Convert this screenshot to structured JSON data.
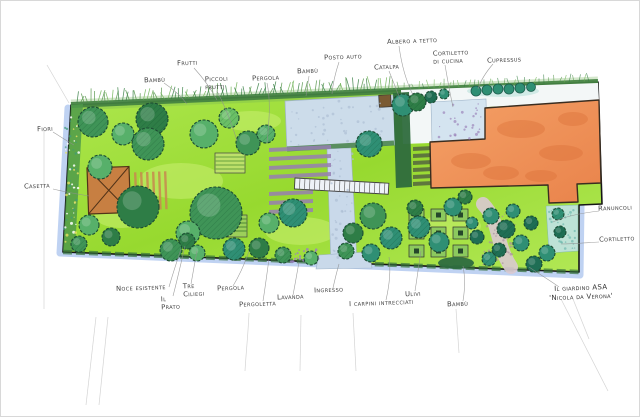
{
  "document": {
    "kind": "hand-drawn watercolor garden plan"
  },
  "palette": {
    "lawn_green": "#a3e042",
    "tree_green_dark": "#2e7d46",
    "tree_teal": "#2f8f74",
    "building_terracotta": "#ef9355",
    "paving_blue": "#ccdcea",
    "pergola_purple": "#977fb2",
    "edge_shadow_blue": "#a9c3ee",
    "ink": "#3c3c3c"
  },
  "plan": {
    "title": {
      "line1": "Il giardino ASA",
      "line2": "'Nicola da Verona'"
    },
    "labels": [
      {
        "id": "bambu-north",
        "text": "Bambù",
        "x": 143,
        "y": 75
      },
      {
        "id": "frutti",
        "text": "Frutti",
        "x": 176,
        "y": 58
      },
      {
        "id": "piccoli-frutti",
        "text": "Piccoli\nfrutti",
        "x": 204,
        "y": 74
      },
      {
        "id": "pergola-nord",
        "text": "Pergola",
        "x": 251,
        "y": 73
      },
      {
        "id": "bambu-centro",
        "text": "Bambù",
        "x": 296,
        "y": 66
      },
      {
        "id": "posto-auto",
        "text": "Posto auto",
        "x": 323,
        "y": 52
      },
      {
        "id": "albero-a-tetto",
        "text": "Albero a tetto",
        "x": 386,
        "y": 36
      },
      {
        "id": "catalpa",
        "text": "Catalpa",
        "x": 373,
        "y": 62
      },
      {
        "id": "cortiletto-di-cucina",
        "text": "Cortiletto\ndi cucina",
        "x": 432,
        "y": 48
      },
      {
        "id": "cupressus",
        "text": "Cupressus",
        "x": 486,
        "y": 55
      },
      {
        "id": "fiori",
        "text": "Fiori",
        "x": 36,
        "y": 124
      },
      {
        "id": "casetta",
        "text": "Casetta",
        "x": 23,
        "y": 181
      },
      {
        "id": "noce-esistente",
        "text": "Noce esistente",
        "x": 115,
        "y": 283
      },
      {
        "id": "il-prato",
        "text": "Il\nPrato",
        "x": 160,
        "y": 294
      },
      {
        "id": "tre-ciliegi",
        "text": "Tre\nCiliegi",
        "x": 182,
        "y": 281
      },
      {
        "id": "pergola-sud",
        "text": "Pergola",
        "x": 216,
        "y": 283
      },
      {
        "id": "pergoletta",
        "text": "Pergoletta",
        "x": 238,
        "y": 299
      },
      {
        "id": "lavanda",
        "text": "Lavanda",
        "x": 276,
        "y": 292
      },
      {
        "id": "ingresso",
        "text": "Ingresso",
        "x": 313,
        "y": 285
      },
      {
        "id": "carpini-intrecciati",
        "text": "I carpini intrecciati",
        "x": 348,
        "y": 298
      },
      {
        "id": "ulivi",
        "text": "Ulivi",
        "x": 404,
        "y": 289
      },
      {
        "id": "bambu-sud",
        "text": "Bambù",
        "x": 446,
        "y": 299
      },
      {
        "id": "ranuncoli",
        "text": "Ranuncoli",
        "x": 597,
        "y": 203
      },
      {
        "id": "cortiletto",
        "text": "Cortiletto",
        "x": 598,
        "y": 234
      }
    ]
  }
}
